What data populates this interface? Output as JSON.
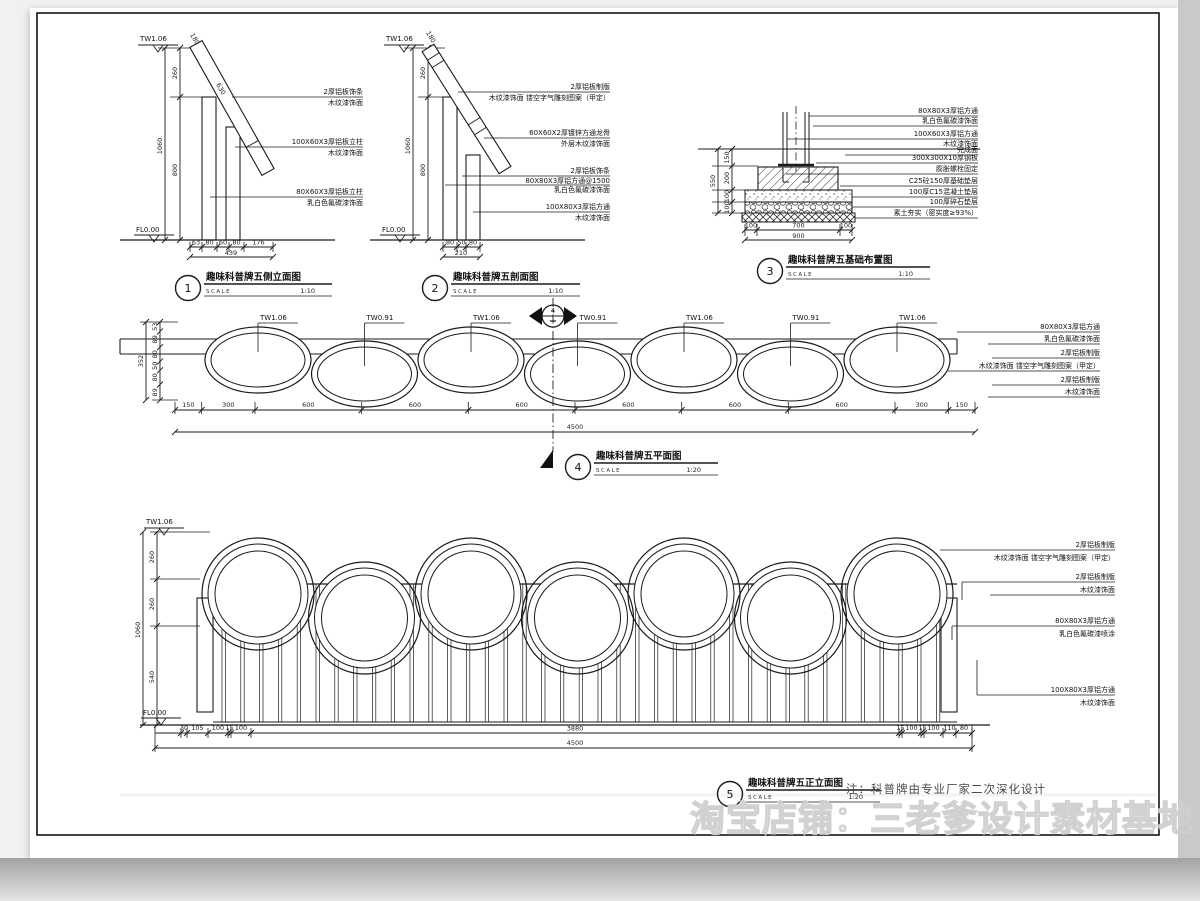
{
  "watermark": "淘宝店铺：三老爹设计素材基地",
  "note": "注：科普牌由专业厂家二次深化设计",
  "common": {
    "scale_label": "SCALE"
  },
  "levels": {
    "tw106": "TW1.06",
    "tw091": "TW0.91",
    "fl000": "FL0.00"
  },
  "drawings": {
    "d1": {
      "num": "1",
      "title": "趣味科普牌五侧立面图",
      "scale": "1:10",
      "dims_v": [
        "260",
        "1060",
        "800"
      ],
      "dims_h": [
        "63",
        "80",
        "60",
        "80",
        "176",
        "439"
      ],
      "dims_diag": [
        "180",
        "630"
      ],
      "callouts": [
        {
          "l1": "2厚铝板饰条",
          "l2": "木纹漆饰面"
        },
        {
          "l1": "100X60X3厚铝板立柱",
          "l2": "木纹漆饰面"
        },
        {
          "l1": "80X60X3厚铝板立柱",
          "l2": "乳白色氟碳漆饰面"
        }
      ]
    },
    "d2": {
      "num": "2",
      "title": "趣味科普牌五剖面图",
      "scale": "1:10",
      "dims_v": [
        "260",
        "1060",
        "800"
      ],
      "dims_h": [
        "80",
        "50",
        "80",
        "210"
      ],
      "dims_diag": [
        "180"
      ],
      "callouts": [
        {
          "l1": "2厚铝板制版",
          "l2": "木纹漆饰面 镂空字气雕刻图案（甲定）"
        },
        {
          "l1": "60X60X2厚镀锌方通龙骨",
          "l2": "外层木纹漆饰面"
        },
        {
          "l1": "2厚铝板饰条",
          "l2": "80X80X3厚铝方通@1500",
          "l3": "乳白色氟碳漆饰面"
        },
        {
          "l1": "100X80X3厚铝方通",
          "l2": "木纹漆饰面"
        }
      ]
    },
    "d3": {
      "num": "3",
      "title": "趣味科普牌五基础布置图",
      "scale": "1:10",
      "dims_left": [
        "150",
        "200",
        "100",
        "100",
        "550"
      ],
      "dims_bottom": [
        "100",
        "700",
        "100",
        "900"
      ],
      "callouts": [
        "80X80X3厚铝方通",
        "乳白色氟碳漆饰面",
        "100X60X3厚铝方通",
        "木纹漆饰面",
        "完成面",
        "300X300X10厚钢板",
        "膨胀螺栓固定",
        "C25砼150厚基础垫层",
        "100厚C15混凝土垫层",
        "100厚碎石垫层",
        "素土夯实（密实度≥93%）"
      ]
    },
    "d4": {
      "num": "4",
      "title": "趣味科普牌五平面图",
      "scale": "1:20",
      "section_mark": {
        "top": "4"
      },
      "level_labels": [
        "TW1.06",
        "TW0.91",
        "TW1.06",
        "TW0.91",
        "TW1.06",
        "TW0.91",
        "TW1.06"
      ],
      "dims_left": [
        "53",
        "89",
        "80",
        "50",
        "80",
        "89",
        "352"
      ],
      "dims_bottom": [
        "150",
        "300",
        "600",
        "600",
        "600",
        "600",
        "600",
        "600",
        "300",
        "150"
      ],
      "dim_total": "4500",
      "callouts": [
        {
          "l1": "80X80X3厚铝方通",
          "l2": "乳白色氟碳漆饰面"
        },
        {
          "l1": "2厚铝板制版",
          "l2": "木纹漆饰面 镂空字气雕刻图案（甲定）"
        },
        {
          "l1": "2厚铝板制版",
          "l2": "木纹漆饰面"
        }
      ]
    },
    "d5": {
      "num": "5",
      "title": "趣味科普牌五正立面图",
      "scale": "1:20",
      "dims_left": [
        "260",
        "260",
        "540",
        "1060"
      ],
      "dims_bottom_left": [
        "30",
        "105",
        "100",
        "15",
        "100"
      ],
      "dim_mid": "3880",
      "dims_bottom_right": [
        "15",
        "100",
        "15",
        "100",
        "110",
        "80"
      ],
      "dim_total": "4500",
      "callouts": [
        {
          "l1": "2厚铝板制版",
          "l2": "木纹漆饰面 镂空字气雕刻图案（甲定）"
        },
        {
          "l1": "2厚铝板制版",
          "l2": "木纹漆饰面"
        },
        {
          "l1": "80X80X3厚铝方通",
          "l2": "乳白色氟碳漆喷涂"
        },
        {
          "l1": "100X80X3厚铝方通",
          "l2": "木纹漆饰面"
        }
      ]
    }
  }
}
